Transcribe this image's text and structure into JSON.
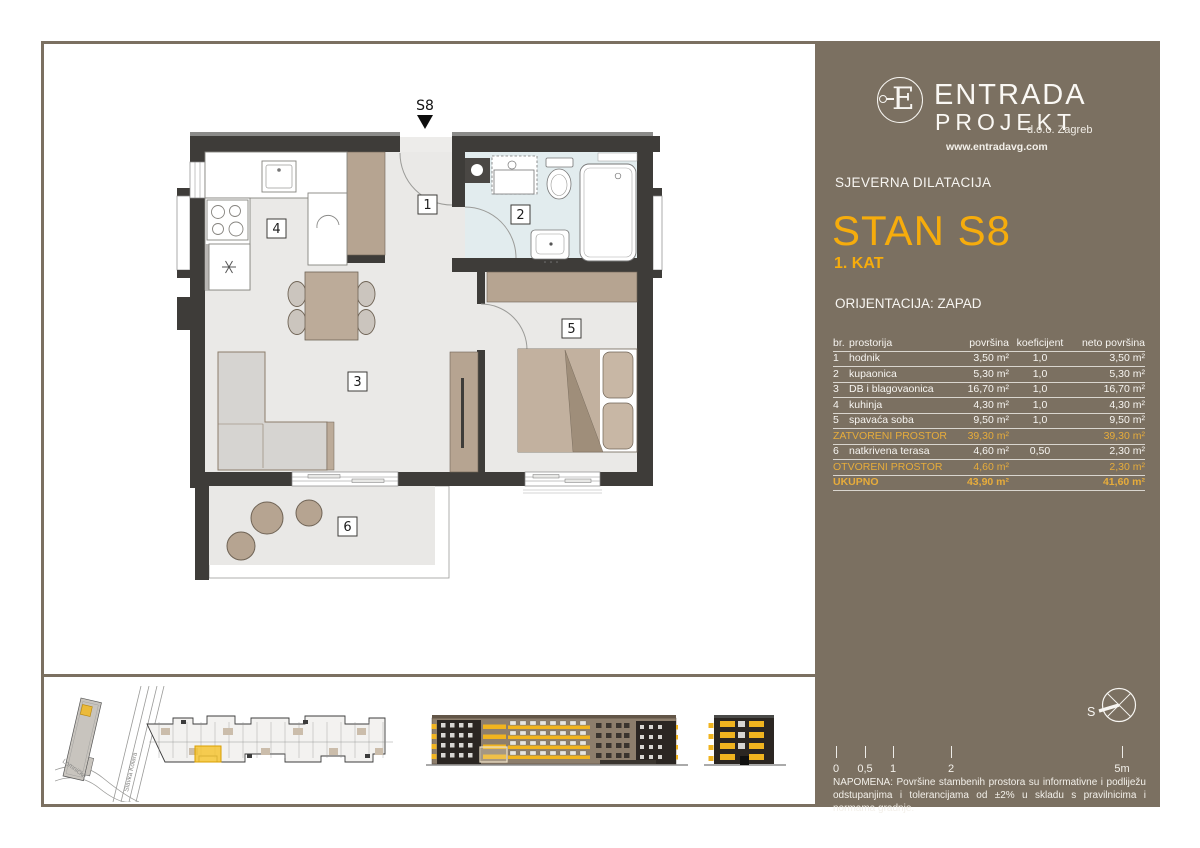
{
  "colors": {
    "panel": "#7B7061",
    "accent_title": "#F6AC0C",
    "accent_table": "#E7AC3B",
    "plan_wall": "#3E3C39",
    "elevation_yellow": "#F1B41F",
    "bathroom_floor": "#E2ECEE"
  },
  "plan": {
    "marker": "S8",
    "room_labels": [
      "1",
      "2",
      "3",
      "4",
      "5",
      "6"
    ]
  },
  "minimap": {
    "streets": [
      "Slavka Kolara",
      "Lomnička"
    ]
  },
  "brand": {
    "monogram": "E",
    "name1": "ENTRADA",
    "name2": "PROJEKT",
    "suffix": "d.o.o. Zagreb",
    "website": "www.entradavg.com"
  },
  "header": {
    "section": "SJEVERNA DILATACIJA",
    "unit_title": "STAN S8",
    "floor": "1. KAT",
    "orientation": "ORIJENTACIJA: ZAPAD"
  },
  "table": {
    "headers": [
      "br.",
      "prostorija",
      "površina",
      "koeficijent",
      "neto površina"
    ],
    "rows": [
      {
        "num": "1",
        "name": "hodnik",
        "area": "3,50 m²",
        "coef": "1,0",
        "net": "3,50 m²"
      },
      {
        "num": "2",
        "name": "kupaonica",
        "area": "5,30 m²",
        "coef": "1,0",
        "net": "5,30 m²"
      },
      {
        "num": "3",
        "name": "DB i blagovaonica",
        "area": "16,70 m²",
        "coef": "1,0",
        "net": "16,70 m²"
      },
      {
        "num": "4",
        "name": "kuhinja",
        "area": "4,30 m²",
        "coef": "1,0",
        "net": "4,30 m²"
      },
      {
        "num": "5",
        "name": "spavaća soba",
        "area": "9,50 m²",
        "coef": "1,0",
        "net": "9,50 m²"
      }
    ],
    "closed_total": {
      "name": "ZATVORENI PROSTOR",
      "area": "39,30 m²",
      "net": "39,30 m²"
    },
    "terrace_row": {
      "num": "6",
      "name": "natkrivena terasa",
      "area": "4,60 m²",
      "coef": "0,50",
      "net": "2,30 m²"
    },
    "open_total": {
      "name": "OTVORENI PROSTOR",
      "area": "4,60 m²",
      "net": "2,30 m²"
    },
    "grand_total": {
      "name": "UKUPNO",
      "area": "43,90 m²",
      "net": "41,60 m²"
    }
  },
  "compass": {
    "label": "S"
  },
  "scale_bar": {
    "ticks": [
      "0",
      "0,5",
      "1",
      "2",
      "5m"
    ]
  },
  "note": "NAPOMENA: Površine stambenih prostora su informativne i podliježu odstupanjima i tolerancijama od ±2% u skladu s pravilnicima i normama gradnje."
}
